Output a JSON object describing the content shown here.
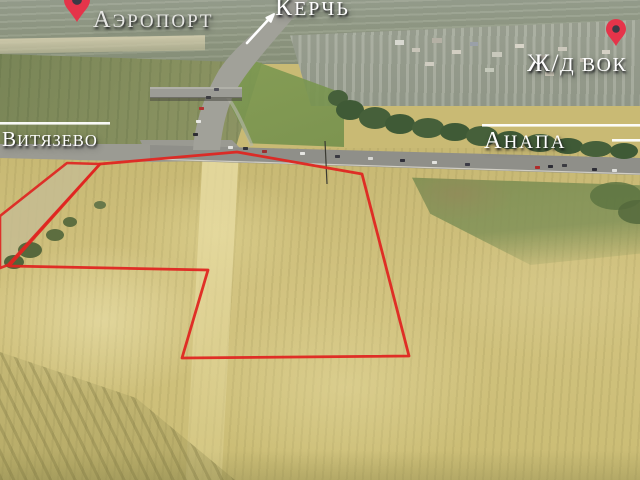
{
  "labels": {
    "airport": "Аэропорт",
    "kerch": "Керчь",
    "railway_station": "Ж/Д Вок",
    "vityazevo": "Витязево",
    "anapa": "Анапа"
  },
  "colors": {
    "plot_outline": "#df2621",
    "pin": "#e5344a",
    "pin_dot": "#3a3a46",
    "label_text": "#ffffff",
    "divider_line": "#ffffff"
  },
  "plot": {
    "main_points": "100,164 237,152 362,174 409,356 182,358 208,270 9,266",
    "strip_points": "0,216 67,163 100,164 8,265 0,268"
  }
}
